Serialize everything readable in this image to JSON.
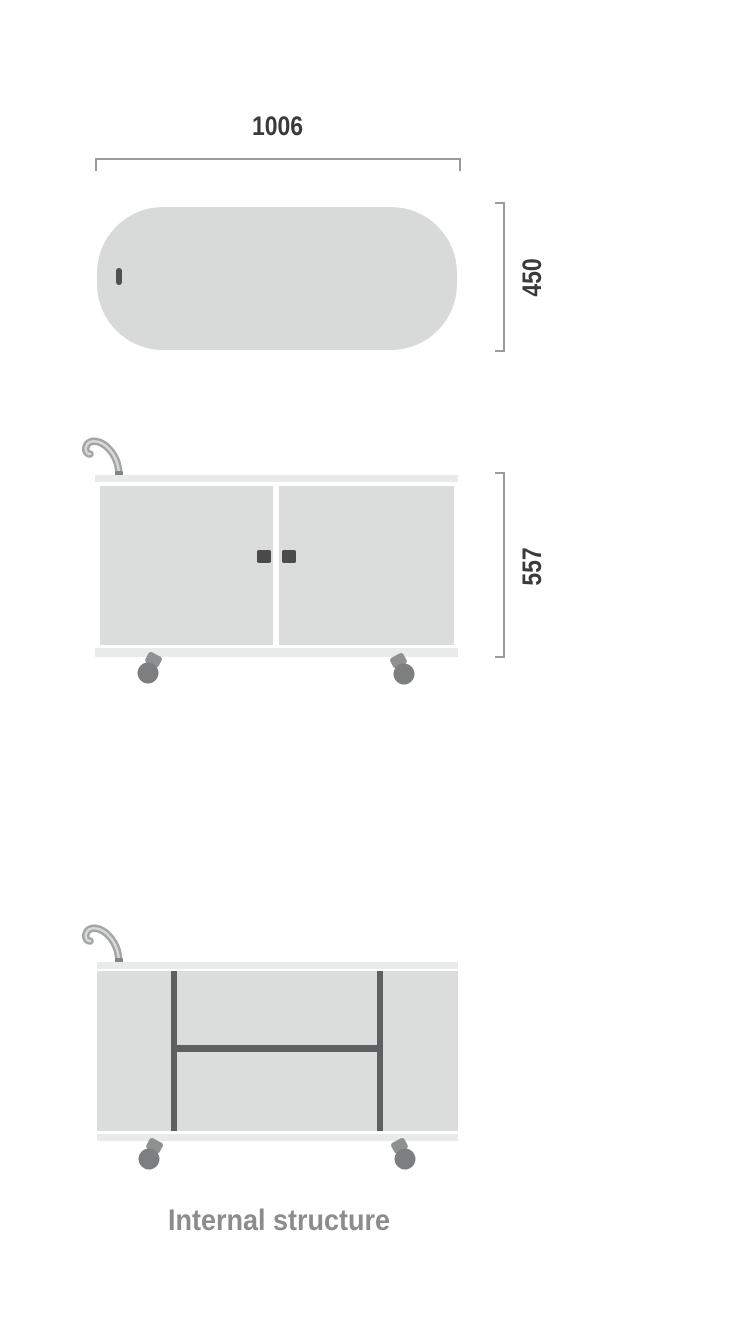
{
  "diagram": {
    "type": "furniture-dimension-drawing",
    "caption": "Internal structure",
    "views": {
      "top_view": {
        "name": "top-view",
        "width_label": "1006",
        "depth_label": "450"
      },
      "front_view": {
        "name": "front-view",
        "height_label": "557"
      },
      "internal_view": {
        "name": "internal-structure-view",
        "caption": "Internal structure"
      }
    },
    "icons": [
      "power-cable-icon",
      "caster-wheel-icon",
      "door-handle-icon"
    ],
    "colors": {
      "background": "#ffffff",
      "top_panel_fill": "#d8d9d9",
      "frame_strip_fill": "#e9eaea",
      "door_fill": "#dbdcdc",
      "structure_line": "#5e5f60",
      "dimension_line": "#9b9b9b",
      "dimension_text": "#3a3a3a",
      "caption_text": "#8c8c8c",
      "caster_fill": "#7d7e80",
      "caster_fork_fill": "#8f9092",
      "handle_fill": "#4b4b4b",
      "cable_fill": "#a4a5a5"
    }
  }
}
